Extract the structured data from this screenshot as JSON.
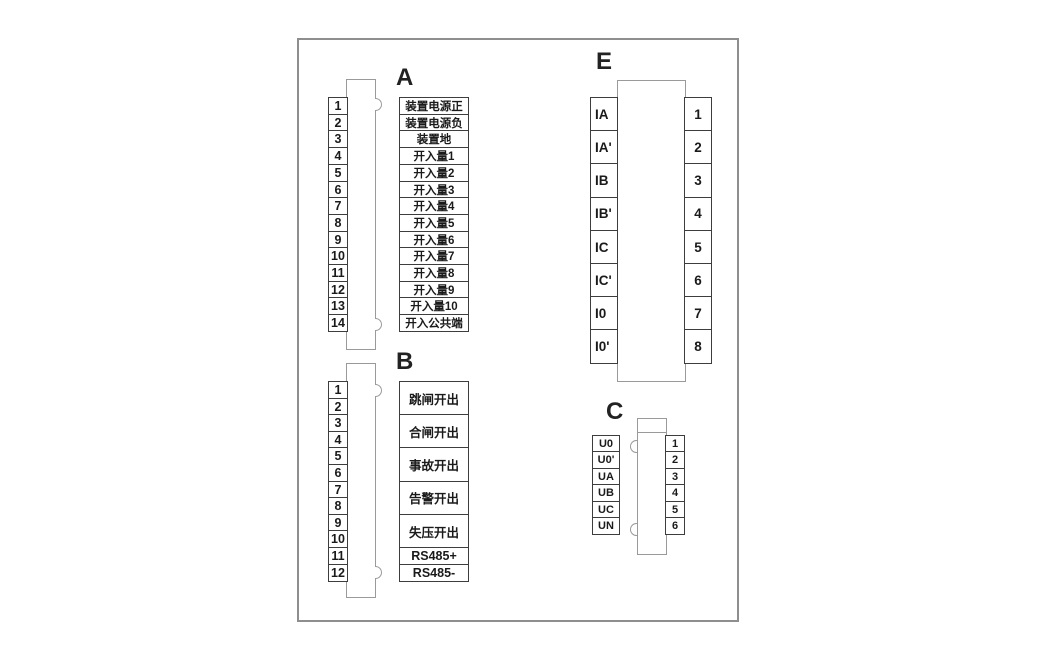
{
  "connector_a": {
    "letter": "A",
    "pins": [
      {
        "num": "1",
        "label": "装置电源正"
      },
      {
        "num": "2",
        "label": "装置电源负"
      },
      {
        "num": "3",
        "label": "装置地"
      },
      {
        "num": "4",
        "label": "开入量1"
      },
      {
        "num": "5",
        "label": "开入量2"
      },
      {
        "num": "6",
        "label": "开入量3"
      },
      {
        "num": "7",
        "label": "开入量4"
      },
      {
        "num": "8",
        "label": "开入量5"
      },
      {
        "num": "9",
        "label": "开入量6"
      },
      {
        "num": "10",
        "label": "开入量7"
      },
      {
        "num": "11",
        "label": "开入量8"
      },
      {
        "num": "12",
        "label": "开入量9"
      },
      {
        "num": "13",
        "label": "开入量10"
      },
      {
        "num": "14",
        "label": "开入公共端"
      }
    ]
  },
  "connector_b": {
    "letter": "B",
    "pins": [
      "1",
      "2",
      "3",
      "4",
      "5",
      "6",
      "7",
      "8",
      "9",
      "10",
      "11",
      "12"
    ],
    "outputs": [
      {
        "text": "跳闸开出",
        "rows": 2
      },
      {
        "text": "合闸开出",
        "rows": 2
      },
      {
        "text": "事故开出",
        "rows": 2
      },
      {
        "text": "告警开出",
        "rows": 2
      },
      {
        "text": "失压开出",
        "rows": 2
      },
      {
        "text": "RS485+",
        "rows": 1
      },
      {
        "text": "RS485-",
        "rows": 1
      }
    ]
  },
  "connector_e": {
    "letter": "E",
    "rows": [
      {
        "label": "IA",
        "num": "1"
      },
      {
        "label": "IA'",
        "num": "2"
      },
      {
        "label": "IB",
        "num": "3"
      },
      {
        "label": "IB'",
        "num": "4"
      },
      {
        "label": "IC",
        "num": "5"
      },
      {
        "label": "IC'",
        "num": "6"
      },
      {
        "label": "I0",
        "num": "7"
      },
      {
        "label": "I0'",
        "num": "8"
      }
    ]
  },
  "connector_c": {
    "letter": "C",
    "rows": [
      {
        "label": "U0",
        "num": "1"
      },
      {
        "label": "U0'",
        "num": "2"
      },
      {
        "label": "UA",
        "num": "3"
      },
      {
        "label": "UB",
        "num": "4"
      },
      {
        "label": "UC",
        "num": "5"
      },
      {
        "label": "UN",
        "num": "6"
      }
    ]
  },
  "colors": {
    "outer_border": "#8e8e8e",
    "connector_body_border": "#9a9a9a",
    "terminal_box_border": "#3d3d3d",
    "text": "#1a1a1a",
    "background": "#ffffff"
  }
}
